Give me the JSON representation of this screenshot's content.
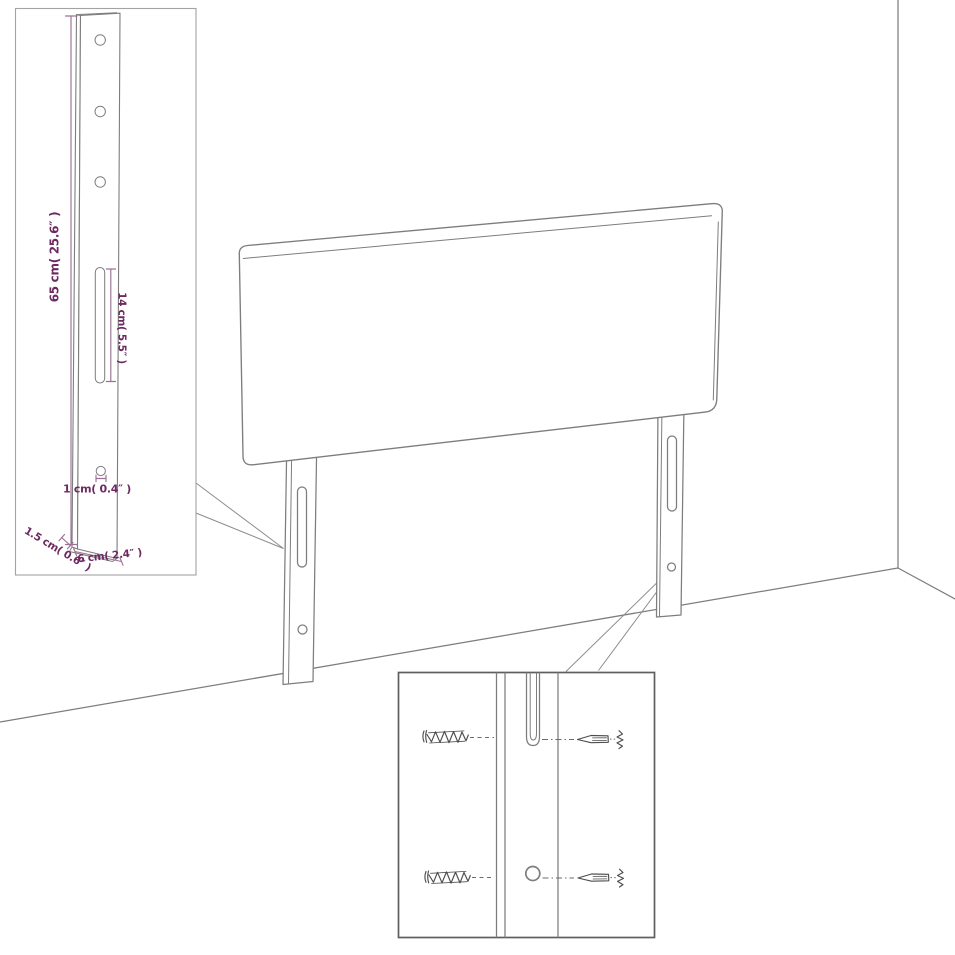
{
  "figure": {
    "type": "furniture-assembly-dimension-diagram",
    "subject": "headboard with two mounting legs, wall corner and mounting-detail insets",
    "colors": {
      "background": "#ffffff",
      "line": "#7d7d7d",
      "accent_text": "#6d2a60",
      "accent_line": "#9c7095"
    },
    "labels": {
      "leg_height": "65 cm( 25.6″ )",
      "slot_length": "14 cm( 5.5″ )",
      "hole_diameter": "1 cm( 0.4″ )",
      "leg_depth": "1.5 cm( 0.6″ )",
      "leg_width": "6 cm( 2.4″ )"
    }
  }
}
